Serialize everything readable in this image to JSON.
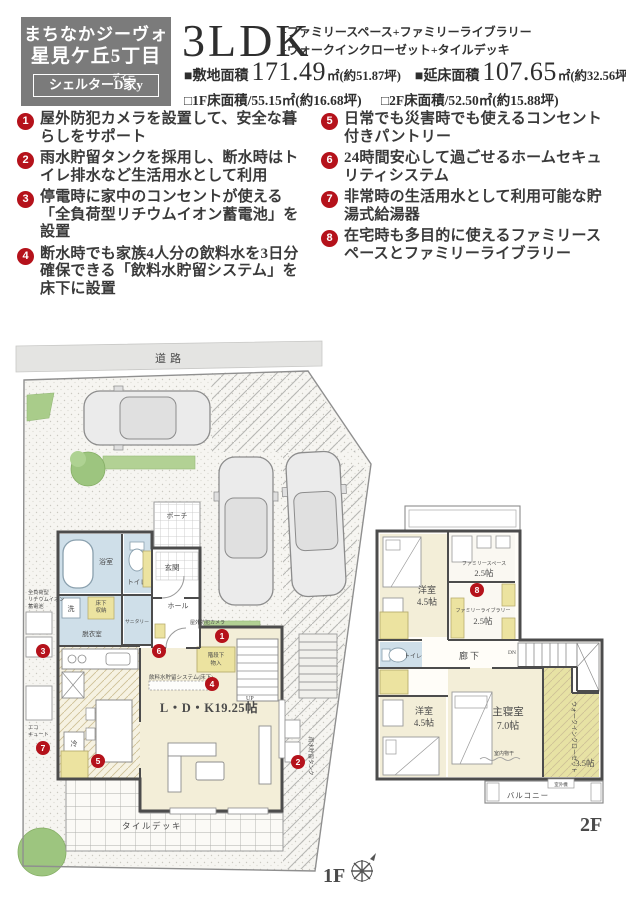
{
  "header": {
    "brand": {
      "line1": "まちなかジーヴォ",
      "line2": "星見ケ丘5丁目",
      "sub": "シェルターD家y",
      "sub_ruby": "ディー"
    },
    "plan_type": "3LDK",
    "extras_line1": "+ファミリースペース+ファミリーライブラリー",
    "extras_line2": "+ウォークインクローゼット+タイルデッキ",
    "areas": {
      "site_label": "■敷地面積",
      "site_value": "171.49",
      "site_unit": "㎡(約51.87坪)",
      "total_label": "■延床面積",
      "total_value": "107.65",
      "total_unit": "㎡(約32.56坪)",
      "f1_label": "□1F床面積/55.15㎡(約16.68坪)",
      "f2_label": "□2F床面積/52.50㎡(約15.88坪)"
    }
  },
  "features": [
    {
      "num": "1",
      "text": "屋外防犯カメラを設置して、安全な暮らしをサポート"
    },
    {
      "num": "2",
      "text": "雨水貯留タンクを採用し、断水時はトイレ排水など生活用水として利用"
    },
    {
      "num": "3",
      "text": "停電時に家中のコンセントが使える「全負荷型リチウムイオン蓄電池」を設置"
    },
    {
      "num": "4",
      "text": "断水時でも家族4人分の飲料水を3日分確保できる「飲料水貯留システム」を床下に設置"
    },
    {
      "num": "5",
      "text": "日常でも災害時でも使えるコンセント付きパントリー"
    },
    {
      "num": "6",
      "text": "24時間安心して過ごせるホームセキュリティシステム"
    },
    {
      "num": "7",
      "text": "非常時の生活用水として利用可能な貯湯式給湯器"
    },
    {
      "num": "8",
      "text": "在宅時も多目的に使えるファミリースペースとファミリーライブラリー"
    }
  ],
  "floor1": {
    "name": "1F",
    "road": "道路",
    "porch": "ポーチ",
    "entrance": "玄関",
    "hall": "ホール",
    "bath": "浴室",
    "toilet": "トイレ",
    "wash": "洗",
    "dressing": "脱衣室",
    "sanitary": "サニタリー",
    "floor_storage_l1": "床下",
    "floor_storage_l2": "収納",
    "under_stairs_l1": "階段下",
    "under_stairs_l2": "物入",
    "up": "UP",
    "ldk": "L・D・K19.25帖",
    "tile_deck": "タイルデッキ",
    "water_system": "飲料水貯留システム(床下)",
    "battery_l1": "全負荷型",
    "battery_l2": "リチウムイオン",
    "battery_l3": "蓄電池",
    "eco_l1": "エコ",
    "eco_l2": "キュート",
    "camera": "屋外防犯カメラ",
    "rain_tank": "雨水貯留タンク",
    "fridge": "冷"
  },
  "floor2": {
    "name": "2F",
    "bedroom1": "洋室",
    "bedroom1_size": "4.5帖",
    "bedroom2": "洋室",
    "bedroom2_size": "4.5帖",
    "family_space": "ファミリースペース",
    "family_space_size": "2.5帖",
    "family_library": "ファミリーライブラリー",
    "family_library_size": "2.5帖",
    "hallway": "廊下",
    "toilet": "トイレ",
    "dn": "DN",
    "master": "主寝室",
    "master_size": "7.0帖",
    "wic": "ウォークインクローゼット",
    "wic_size": "3.5帖",
    "indoor_drying": "室内物干",
    "ac_unit": "室外機",
    "balcony": "バルコニー"
  },
  "colors": {
    "accent_red": "#b5121b",
    "header_gray": "#7b7b7b",
    "room_cream": "#f3eed8",
    "room_blue": "#cfdfe9",
    "room_yellow": "#ece3a0",
    "green": "#9dc57f"
  }
}
